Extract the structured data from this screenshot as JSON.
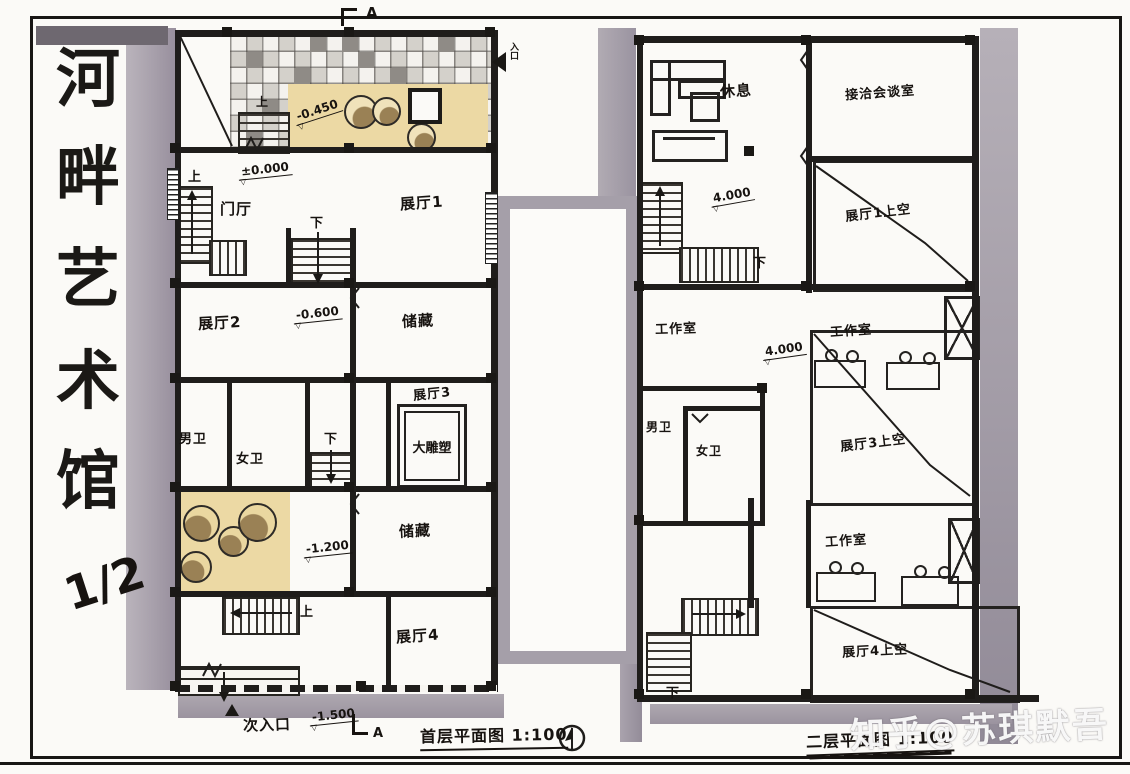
{
  "artwork_title": {
    "name": "河畔艺术馆",
    "chars": [
      "河",
      "畔",
      "艺",
      "术",
      "馆"
    ],
    "sheet": "1/2"
  },
  "floor1": {
    "caption": "首层平面图 1:100",
    "section_top": "A",
    "section_bottom": "A",
    "main_entrance": "入口",
    "secondary_entrance": "次入口",
    "rooms": {
      "entry_hall": "门厅",
      "exhibit1": "展厅1",
      "exhibit2": "展厅2",
      "exhibit3": "展厅3",
      "exhibit4": "展厅4",
      "storage1": "储藏",
      "storage2": "储藏",
      "mens_wc": "男卫",
      "womens_wc": "女卫",
      "sculpture": "大雕塑"
    },
    "stairs": {
      "up0": "上",
      "up1": "上",
      "down1": "下",
      "down2": "下",
      "up2": "上"
    },
    "levels": {
      "zero": "±0.000",
      "m045": "-0.450",
      "m060": "-0.600",
      "m120": "-1.200",
      "m150": "-1.500"
    }
  },
  "floor2": {
    "caption": "二层平面图 1:100",
    "rooms": {
      "lounge": "休息",
      "meeting": "接洽会谈室",
      "studio1": "工作室",
      "studio2": "工作室",
      "studio3": "工作室",
      "mens_wc": "男卫",
      "womens_wc": "女卫"
    },
    "voids": {
      "v1": "展厅1上空",
      "v3": "展厅3上空",
      "v4": "展厅4上空"
    },
    "stairs": {
      "down1": "下",
      "down2": "下"
    },
    "levels": {
      "l4a": "4.000",
      "l4b": "4.000"
    }
  },
  "watermark": "知乎@苏琪默吾"
}
